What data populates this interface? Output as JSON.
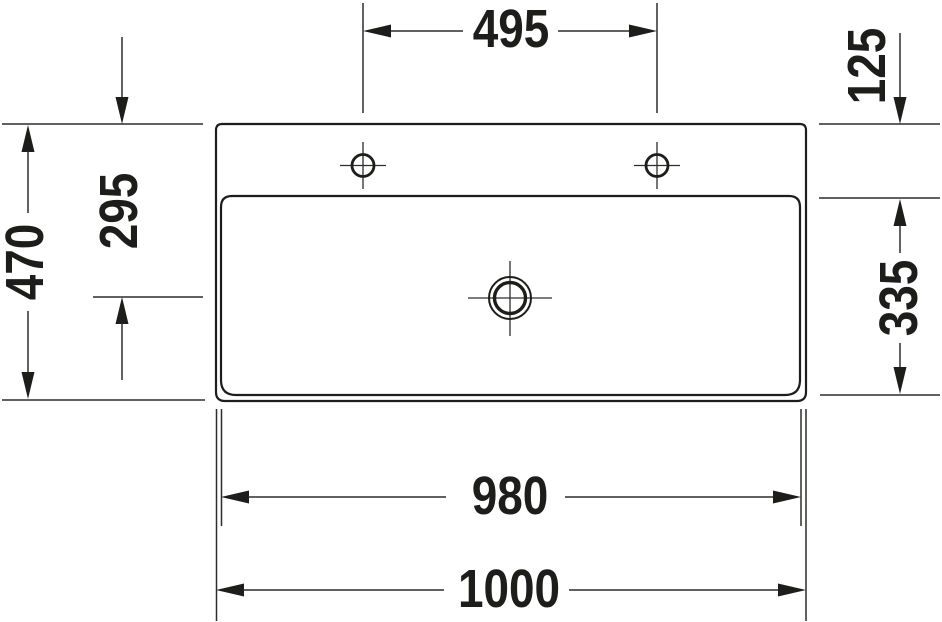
{
  "drawing": {
    "background_color": "#ffffff",
    "line_color": "#1d1d1b",
    "dimensions": {
      "faucet_hole_spacing": "495",
      "rim_to_bowl_top": "125",
      "bowl_depth": "335",
      "overall_depth": "470",
      "front_to_drain_center": "295",
      "bowl_width": "980",
      "overall_width": "1000"
    }
  }
}
